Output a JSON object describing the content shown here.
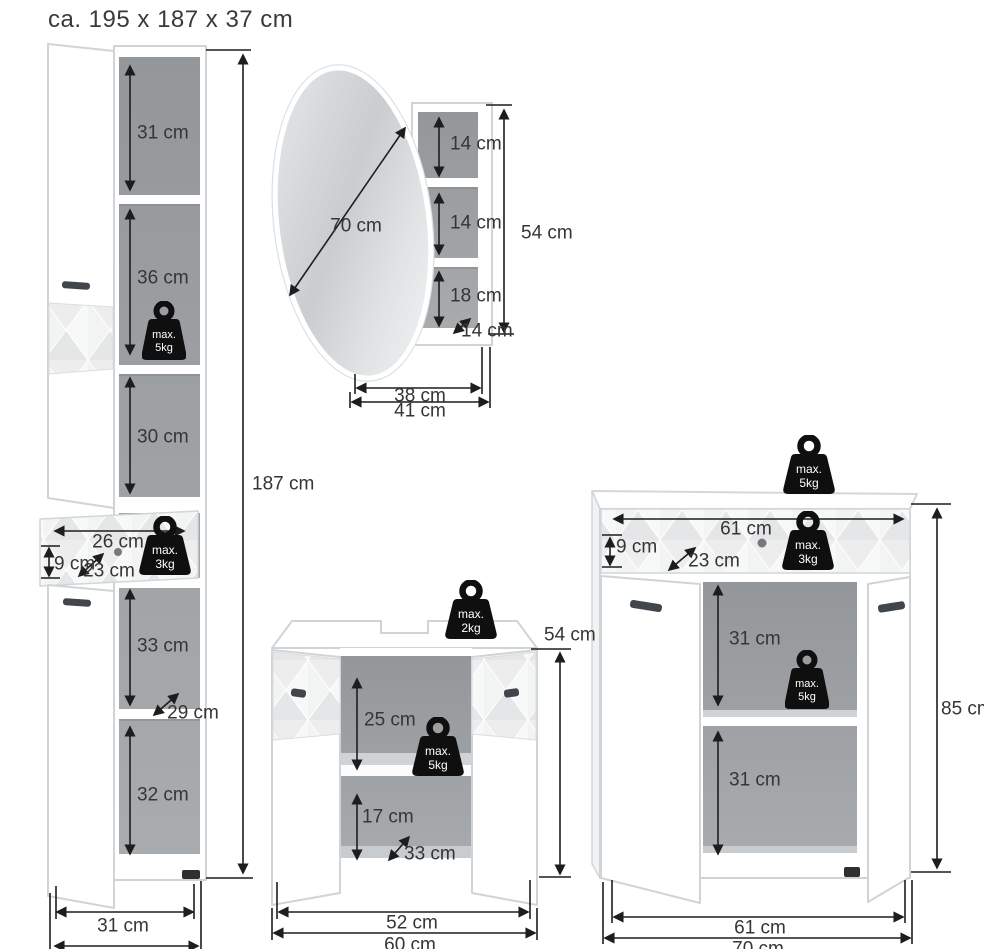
{
  "title": "ca. 195 x 187 x 37 cm",
  "weight_badges": {
    "max_5kg": {
      "line1": "max.",
      "line2": "5kg"
    },
    "max_3kg": {
      "line1": "max.",
      "line2": "3kg"
    },
    "max_2kg": {
      "line1": "max.",
      "line2": "2kg"
    }
  },
  "tall_cabinet": {
    "overall_height": "187 cm",
    "top_compartment": "31 cm",
    "second_compartment": "36 cm",
    "open_shelf": "30 cm",
    "drawer_width": "26 cm",
    "drawer_front_height": "9 cm",
    "drawer_depth": "23 cm",
    "third_compartment": "33 cm",
    "shelf_depth": "29 cm",
    "bottom_compartment": "32 cm",
    "width": "31 cm"
  },
  "mirror_cabinet": {
    "mirror_diameter": "70 cm",
    "top_shelf": "14 cm",
    "middle_shelf": "14 cm",
    "bottom_shelf": "18 cm",
    "depth": "14 cm",
    "height": "54 cm",
    "body_width": "38 cm",
    "overall_width": "41 cm"
  },
  "washbasin_cabinet": {
    "height": "54 cm",
    "upper_clearance": "25 cm",
    "lower_compartment": "17 cm",
    "depth": "33 cm",
    "body_width": "52 cm",
    "overall_width": "60 cm"
  },
  "chest": {
    "height": "85 cm",
    "drawer_width": "61 cm",
    "drawer_front_height": "9 cm",
    "drawer_depth": "23 cm",
    "upper_compartment": "31 cm",
    "lower_compartment": "31 cm",
    "body_width": "61 cm",
    "overall_width": "70 cm"
  },
  "colors": {
    "line": "#1d1d1d",
    "label_text": "#353535",
    "badge": "#0f0f0f",
    "interior_gray": "#9da0a2",
    "cabinet_edge": "#d0d4d6"
  }
}
